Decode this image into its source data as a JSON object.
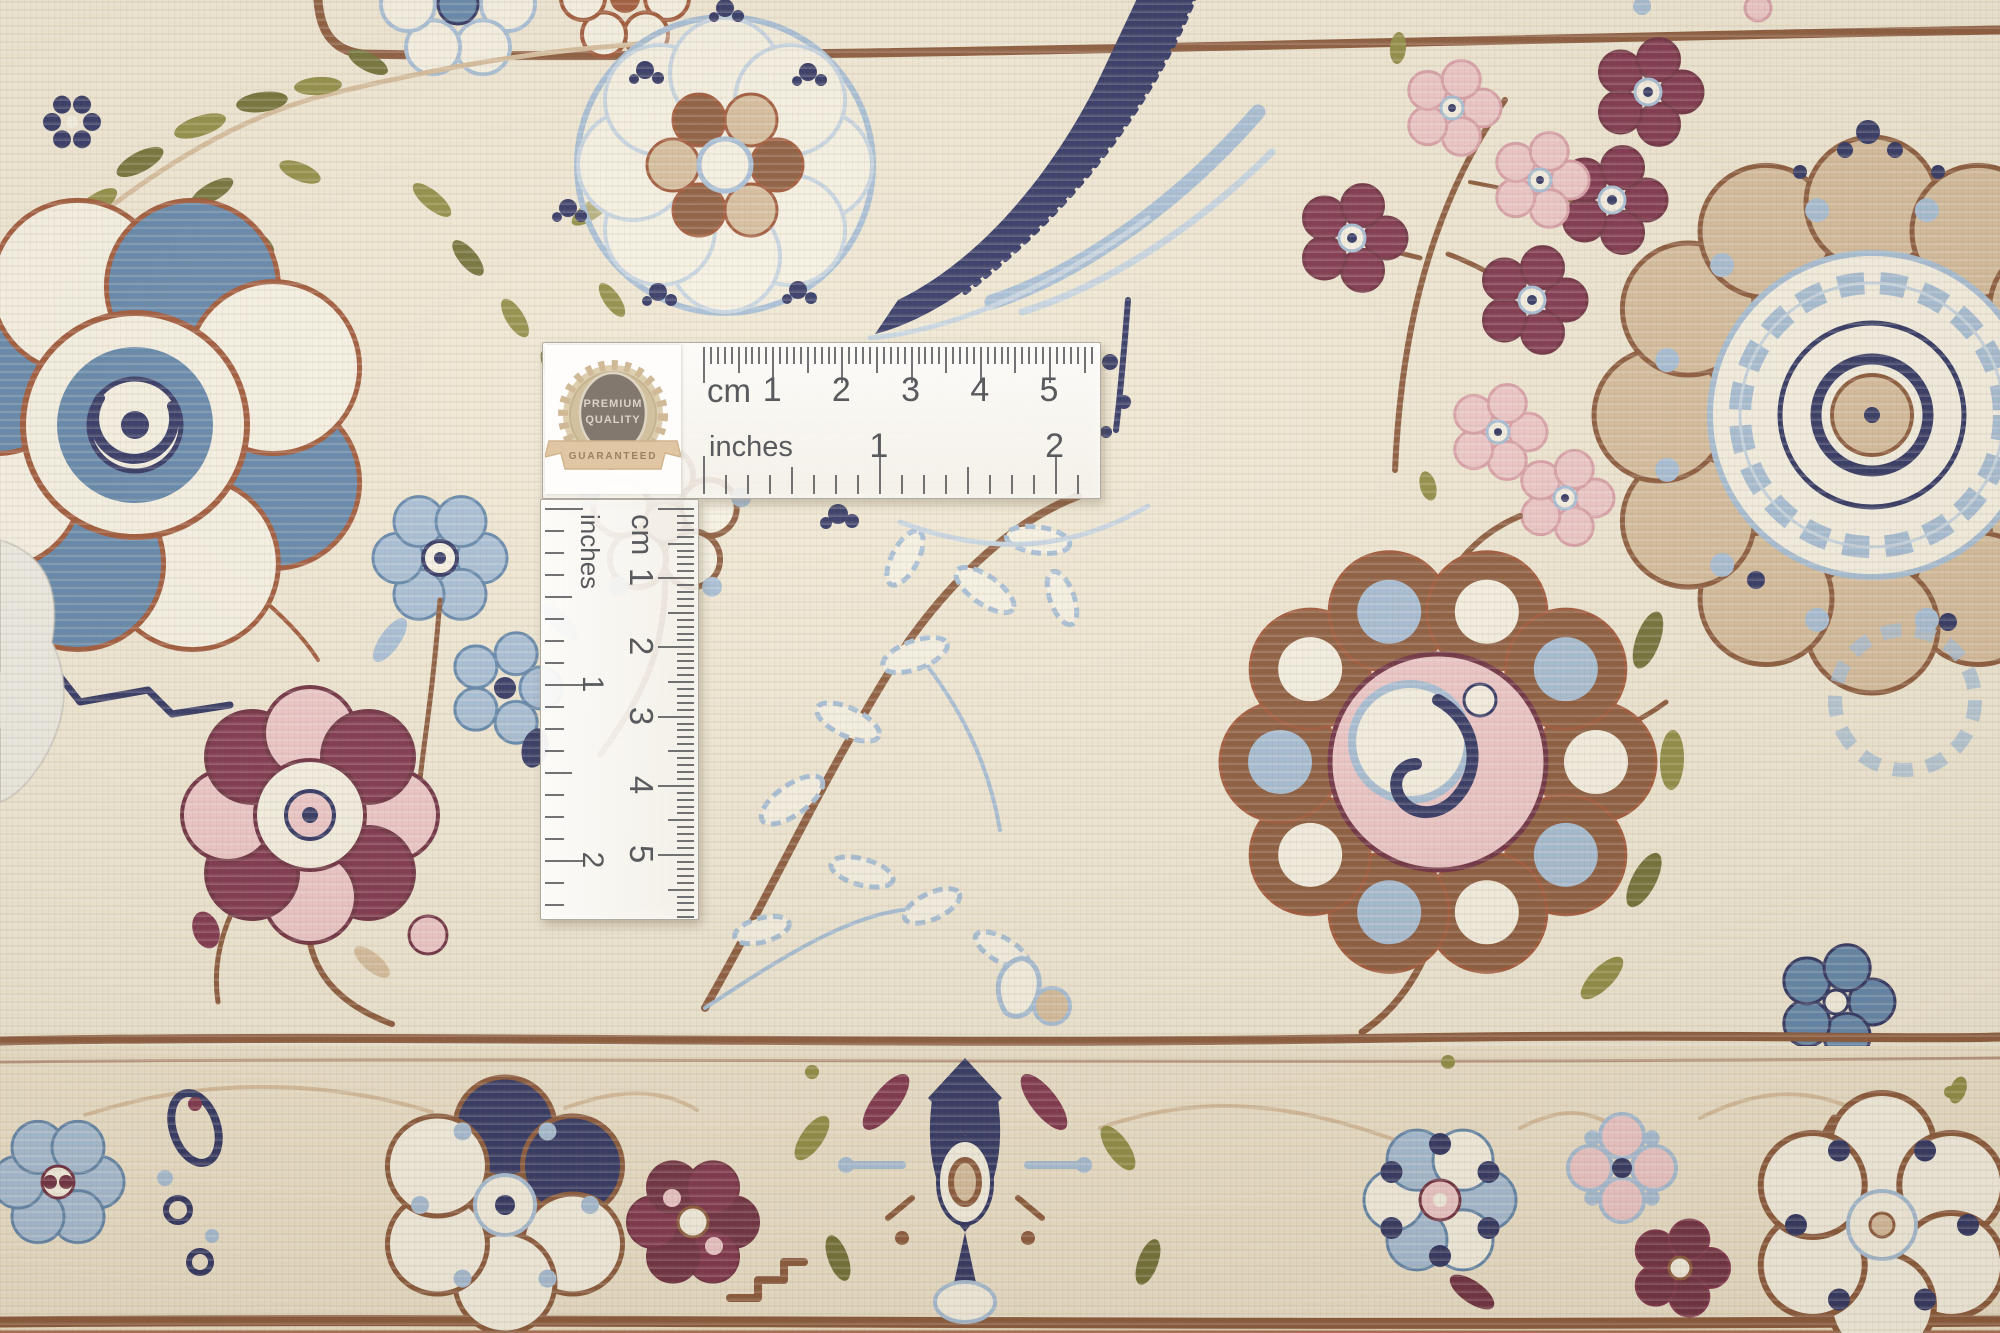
{
  "rulers": {
    "horizontal": {
      "unit_top": "cm",
      "unit_bottom": "inches",
      "cm_numbers": [
        "1",
        "2",
        "3",
        "4",
        "5"
      ],
      "inch_numbers": [
        "1",
        "2"
      ]
    },
    "vertical": {
      "unit_top": "cm",
      "unit_bottom": "inches",
      "cm_numbers": [
        "1",
        "2",
        "3",
        "4",
        "5"
      ],
      "inch_numbers": [
        "1",
        "2"
      ]
    }
  },
  "badge": {
    "line1": "PREMIUM",
    "line2": "QUALITY",
    "line3": "GUARANTEED"
  },
  "palette": {
    "field": "#f0e8d3",
    "band": "#ece1c9",
    "knot": "#f7f2e3",
    "brown": "#8a5738",
    "brick": "#9e5434",
    "tan": "#d6bd9b",
    "navy": "#2d3260",
    "steel": "#5f84a9",
    "lblue": "#a6bed6",
    "paleblue": "#c6d5e2",
    "burgundy": "#7d3049",
    "maroon": "#6d2c3e",
    "pink": "#eec7c8",
    "rose": "#d99fa6",
    "olive": "#8f8b41",
    "olivedk": "#6f6e33",
    "fabric": "#edebe3",
    "ruler_ink": "#595a5e",
    "badge_gold": "#c9ae86",
    "badge_dark": "#6e6156",
    "badge_ribbon": "#dcbd94"
  }
}
